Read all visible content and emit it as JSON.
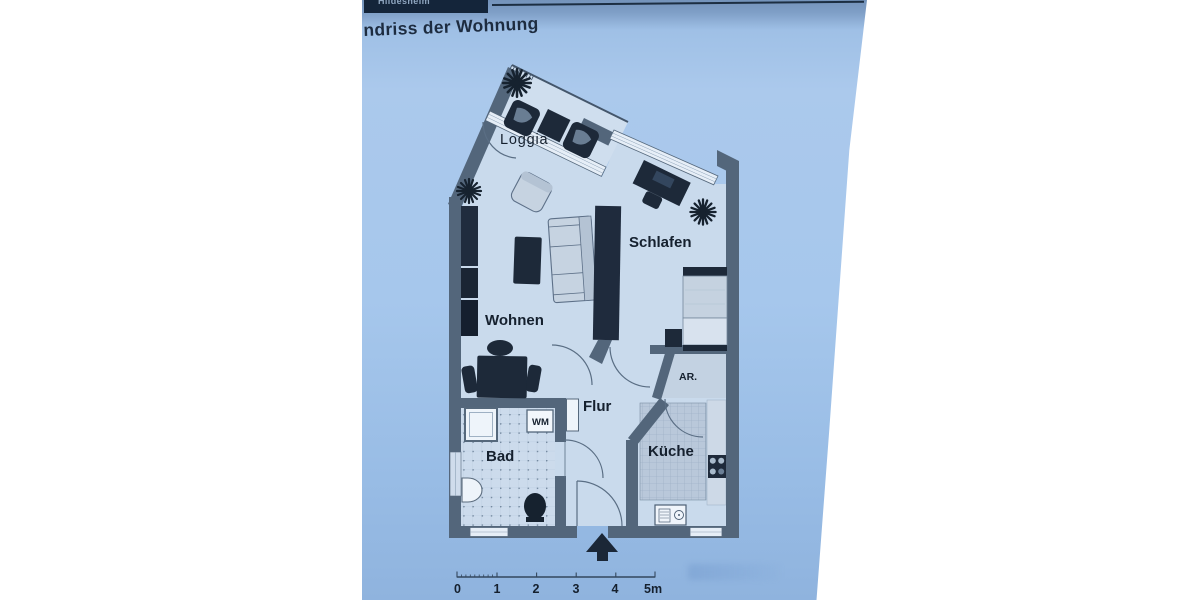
{
  "banner": {
    "text": "Hildesheim"
  },
  "title": {
    "text": "ndriss der Wohnung"
  },
  "floorplan": {
    "room_labels": {
      "loggia": "Loggia",
      "wohnen": "Wohnen",
      "schlafen": "Schlafen",
      "flur": "Flur",
      "bad": "Bad",
      "kueche": "Küche",
      "abstellraum": "AR."
    },
    "appliances": {
      "washing_machine": "WM"
    },
    "scale_bar": {
      "ticks": [
        "0",
        "1",
        "2",
        "3",
        "4",
        "5m"
      ]
    }
  },
  "colors": {
    "page_blue": "#a6c7ec",
    "interior_floor": "#c9daec",
    "wall": "#53667b",
    "furniture_dark": "#1d2939",
    "banner_navy": "#14253a",
    "text_dark": "#15202e"
  }
}
